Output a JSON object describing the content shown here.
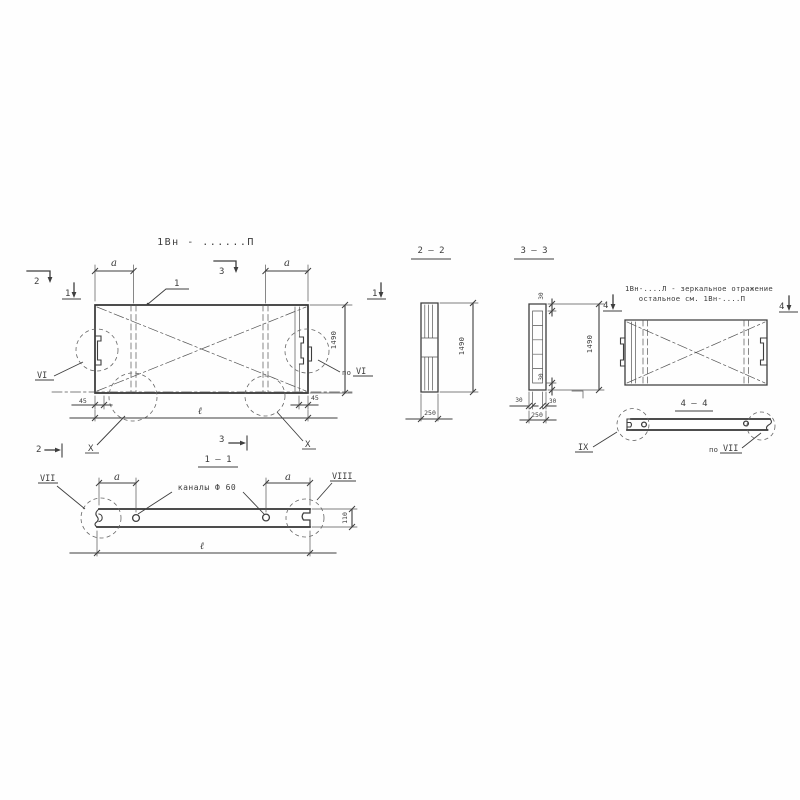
{
  "plan": {
    "title": "1Вн - ......П",
    "callout_1": "1",
    "marker_2": "2",
    "marker_1": "1",
    "marker_3": "3",
    "dim_a": "a",
    "dim_1490": "1490",
    "dim_45": "45",
    "dim_l": "ℓ",
    "label_vi": "VI",
    "label_po": "по",
    "label_x": "X"
  },
  "s11": {
    "title": "1 — 1",
    "channels_label": "каналы Ф 60",
    "dim_a": "a",
    "dim_110": "110",
    "dim_l": "ℓ",
    "label_vii": "VII",
    "label_viii": "VIII"
  },
  "s22": {
    "title": "2 — 2",
    "dim_1490": "1490",
    "dim_250": "250"
  },
  "s33": {
    "title": "3 — 3",
    "dim_1490": "1490",
    "dim_250": "250",
    "dim_30": "30"
  },
  "mirror": {
    "note_line1": "1Вн-....Л - зеркальное отражение",
    "note_line2": "остальное  см. 1Вн-....П",
    "marker_4": "4"
  },
  "s44": {
    "title": "4 — 4",
    "label_ix": "IX",
    "label_po": "по",
    "label_vii": "VII"
  }
}
